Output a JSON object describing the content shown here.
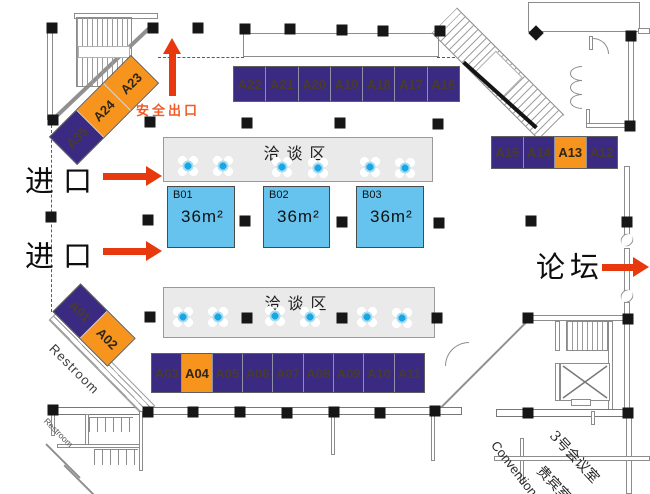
{
  "labels": {
    "safety_exit": "安全出口",
    "entrance_top": "进口",
    "entrance_bottom": "进口",
    "forum": "论坛",
    "negotiation_top": "洽谈区",
    "negotiation_bottom": "洽谈区",
    "restroom_large": "Restroom",
    "restroom_small": "Restroom",
    "convention": "Convention",
    "meeting_room_3": "3号会议室",
    "vip_room": "贵宾室"
  },
  "booths": {
    "top_row": [
      {
        "id": "A22",
        "color": "purple"
      },
      {
        "id": "A21",
        "color": "purple"
      },
      {
        "id": "A20",
        "color": "purple"
      },
      {
        "id": "A19",
        "color": "purple"
      },
      {
        "id": "A18",
        "color": "purple"
      },
      {
        "id": "A17",
        "color": "purple"
      },
      {
        "id": "A16",
        "color": "purple"
      }
    ],
    "right_row": [
      {
        "id": "A15",
        "color": "purple"
      },
      {
        "id": "A14",
        "color": "purple"
      },
      {
        "id": "A13",
        "color": "orange"
      },
      {
        "id": "A12",
        "color": "purple"
      }
    ],
    "bottom_row": [
      {
        "id": "A03",
        "color": "purple"
      },
      {
        "id": "A04",
        "color": "orange"
      },
      {
        "id": "A05",
        "color": "purple"
      },
      {
        "id": "A06",
        "color": "purple"
      },
      {
        "id": "A07",
        "color": "purple"
      },
      {
        "id": "A08",
        "color": "purple"
      },
      {
        "id": "A09",
        "color": "purple"
      },
      {
        "id": "A10",
        "color": "purple"
      },
      {
        "id": "A11",
        "color": "purple"
      }
    ],
    "diagonal_top_left": [
      {
        "id": "A35",
        "color": "purple"
      },
      {
        "id": "A24",
        "color": "orange"
      },
      {
        "id": "A23",
        "color": "orange"
      }
    ],
    "diagonal_left": [
      {
        "id": "A01",
        "color": "purple"
      },
      {
        "id": "A02",
        "color": "orange"
      }
    ],
    "b_booths": [
      {
        "id": "B01",
        "area": "36m²"
      },
      {
        "id": "B02",
        "area": "36m²"
      },
      {
        "id": "B03",
        "area": "36m²"
      }
    ]
  },
  "icons": {
    "table_seat": "round-table-with-four-chairs",
    "column": "structural-column-marker",
    "stairs": "stairs-hatching",
    "elevator": "elevator-crossed-box"
  },
  "colors": {
    "booth_purple": "#3A2A82",
    "booth_orange": "#F7941E",
    "booth_blue": "#66C3ED",
    "bar_gray": "#EAEAEA",
    "arrow_red": "#E8380D",
    "safety_text": "#F15A24"
  }
}
